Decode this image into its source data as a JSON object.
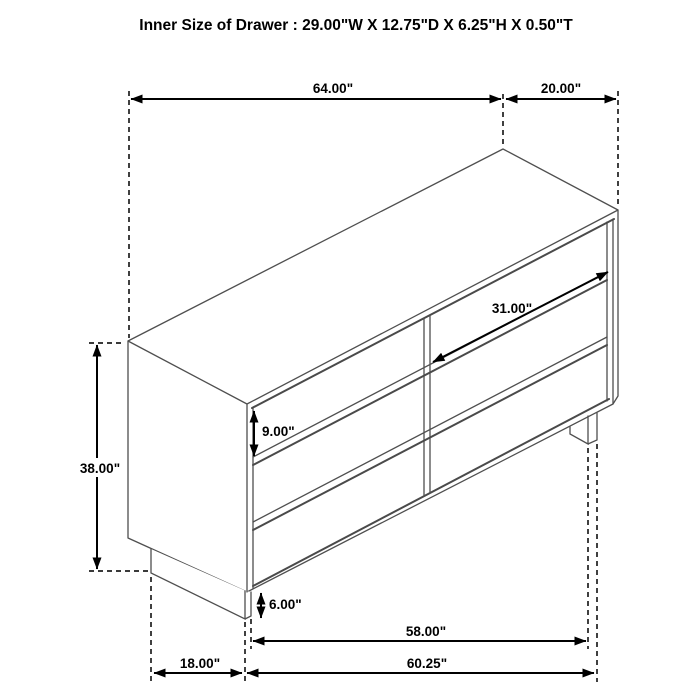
{
  "title": "Inner Size of Drawer : 29.00\"W X 12.75\"D X 6.25\"H X 0.50\"T",
  "diagram": {
    "object": "six-drawer-dresser-dimension-drawing",
    "background": "#ffffff",
    "colors": {
      "drawing_line": "#4f4f4f",
      "dimension_line": "#000000",
      "text": "#000000"
    },
    "inner_drawer_size": {
      "width": "29.00\"",
      "depth": "12.75\"",
      "height": "6.25\"",
      "thickness": "0.50\""
    },
    "dimensions": {
      "top_width": "64.00\"",
      "top_depth": "20.00\"",
      "overall_height": "38.00\"",
      "drawer_front_height": "9.00\"",
      "drawer_front_width": "31.00\"",
      "leg_height": "6.00\"",
      "base_inner_width": "58.00\"",
      "base_side_depth": "18.00\"",
      "base_outer_width": "60.25\""
    }
  }
}
